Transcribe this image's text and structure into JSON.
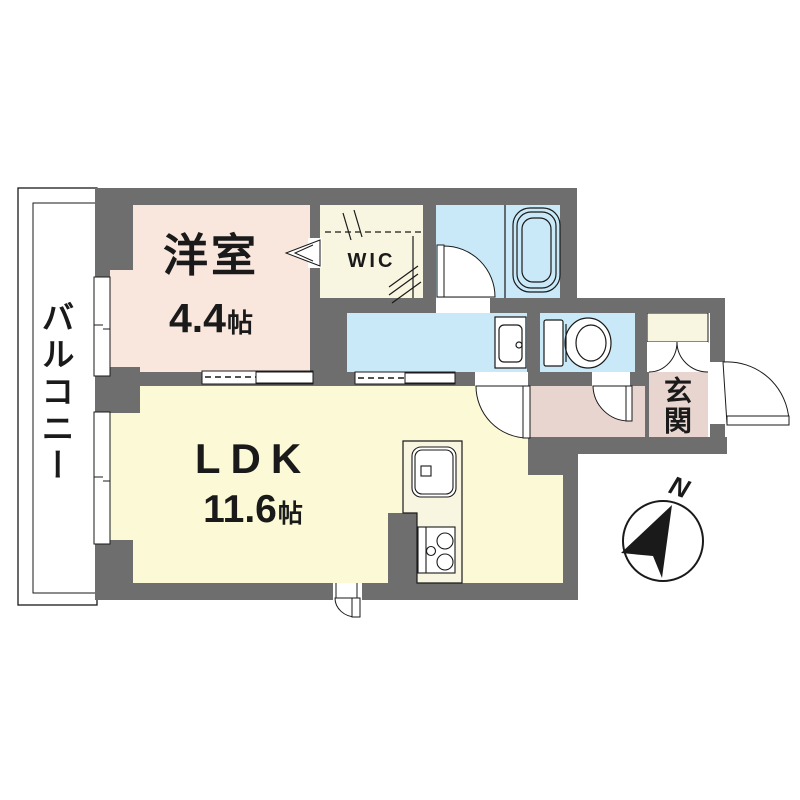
{
  "plan": {
    "rooms": {
      "bedroom": {
        "label": "洋室",
        "size_value": "4.4",
        "size_unit": "帖"
      },
      "ldk": {
        "label": "LDK",
        "size_value": "11.6",
        "size_unit": "帖"
      },
      "wic": {
        "label": "WIC"
      },
      "balcony": {
        "label": "バルコニー"
      },
      "entrance": {
        "label": "玄関"
      }
    },
    "compass": {
      "north_label": "N"
    },
    "colors": {
      "wall": "#6e6e6e",
      "bedroom": "#f9e7dd",
      "ldk": "#fbf9d6",
      "wic": "#f8f5e1",
      "water": "#c9e9f8",
      "entrance": "#e8d5cf",
      "counter": "#f8f5e1",
      "line": "#1a1a1a"
    }
  }
}
